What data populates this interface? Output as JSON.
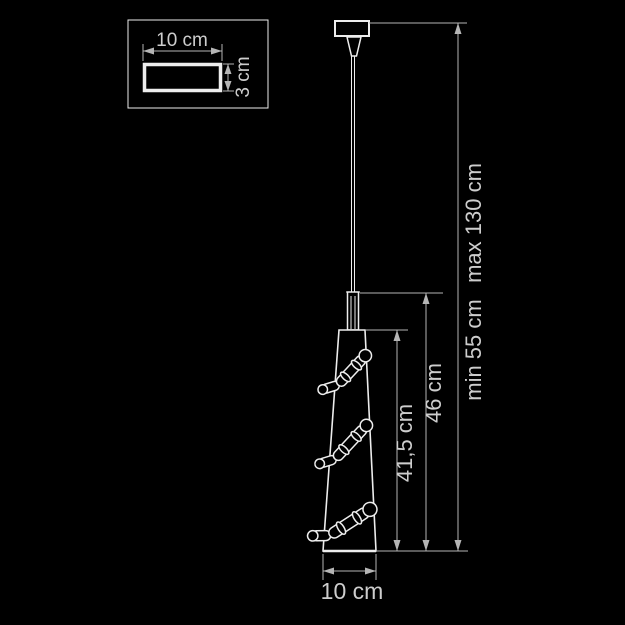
{
  "drawing": {
    "type": "pendant-lamp-dimension-diagram",
    "colors": {
      "background": "#000000",
      "outline": "#ededed",
      "dimension_lines": "#b5b5b5",
      "text": "#cdcdcd"
    },
    "inset": {
      "width_label": "10 cm",
      "depth_label": "3 cm"
    },
    "dims": {
      "shade_height": "41,5 cm",
      "body_height": "46 cm",
      "suspension_min": "min 55 cm",
      "suspension_max": "max 130 cm",
      "shade_diameter": "10 cm"
    }
  }
}
